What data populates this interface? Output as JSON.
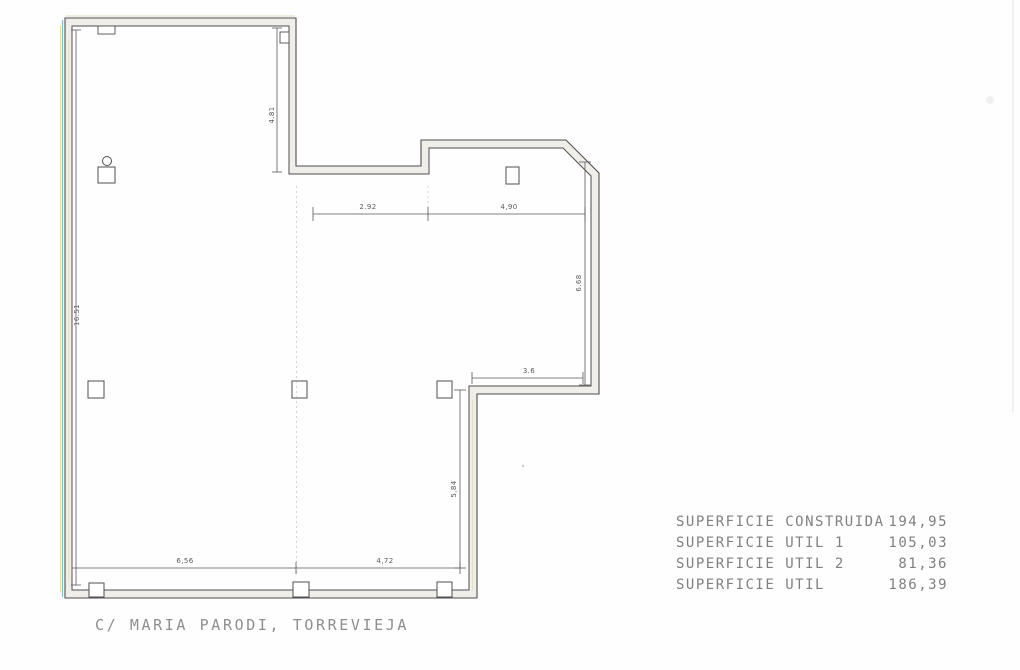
{
  "plan": {
    "address": "C/ MARIA PARODI, TORREVIEJA",
    "dimensions": {
      "upper_left_height": "4.81",
      "left_wall_height": "16.51",
      "top_span_left": "2.92",
      "top_span_right": "4,90",
      "right_room_height": "6.68",
      "right_room_width": "3.6",
      "bottom_span_left": "6,56",
      "bottom_span_right": "4,72",
      "lower_right_height": "5,84"
    }
  },
  "areas": {
    "rows": [
      {
        "label": "SUPERFICIE CONSTRUIDA",
        "value": "194,95"
      },
      {
        "label": "SUPERFICIE UTIL 1",
        "value": "105,03"
      },
      {
        "label": "SUPERFICIE UTIL 2",
        "value": "81,36"
      },
      {
        "label": "SUPERFICIE UTIL",
        "value": "186,39"
      }
    ]
  },
  "colors": {
    "wall_line": "#4f4f4f",
    "wall_fill": "#efeee8",
    "dimension_line": "#5a5a5a",
    "printed_text": "#8e8e8e",
    "scan_fringe_cyan": "#4db3c9",
    "scan_fringe_yellow": "#d9c33f"
  }
}
